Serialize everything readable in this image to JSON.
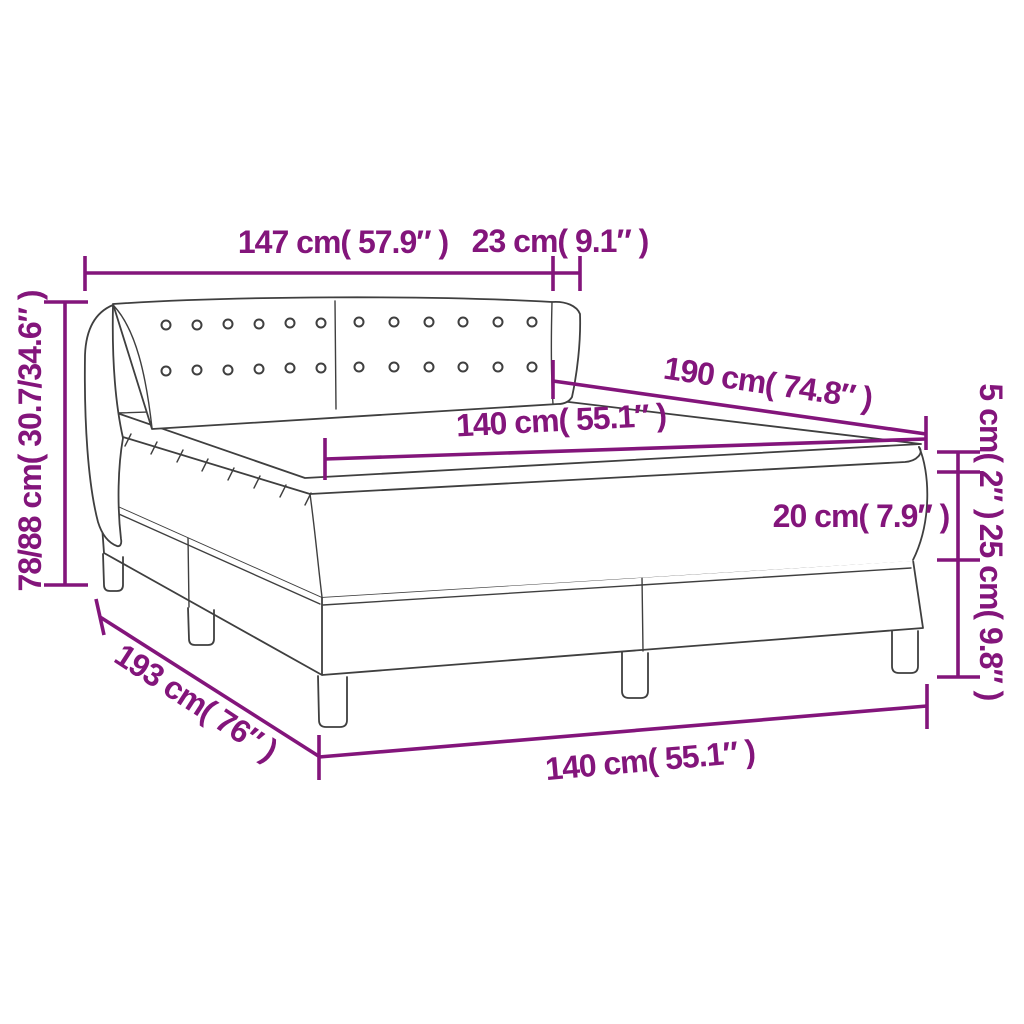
{
  "diagram": {
    "type": "product-dimension-line-drawing",
    "subject": "box-spring-bed-with-headboard-mattress-and-topper",
    "dimensions": {
      "headboard_width": "147 cm( 57.9″ )",
      "wing_depth": "23 cm( 9.1″ )",
      "total_height": "78/88 cm( 30.7/34.6″ )",
      "mattress_length": "190 cm( 74.8″ )",
      "mattress_width": "140 cm( 55.1″ )",
      "topper_thickness": "5 cm( 2″ )",
      "mattress_thickness": "20 cm( 7.9″ )",
      "base_height": "25 cm( 9.8″ )",
      "base_length": "193 cm( 76″ )",
      "base_width": "140 cm( 55.1″ )"
    },
    "colors": {
      "dimension": "#83157B",
      "line_art": "#3F3F3F",
      "background": "#FFFFFF"
    }
  }
}
